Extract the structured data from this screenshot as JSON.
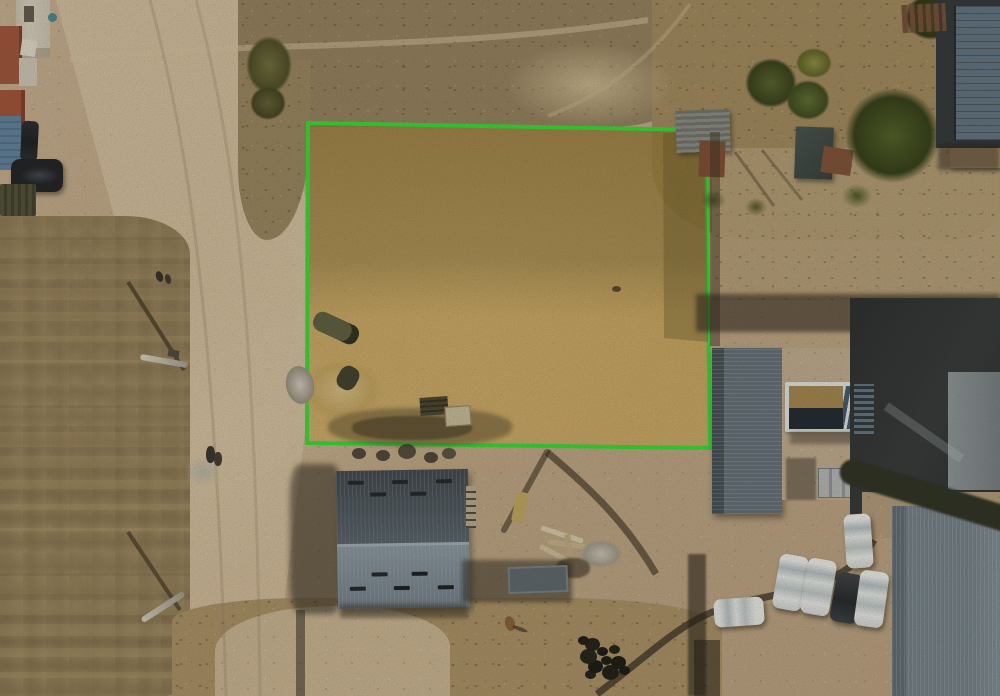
{
  "scene": {
    "kind": "aerial-drone-photo",
    "caption": "Aerial view of a vacant land plot outlined with a green boundary and filled with a yellow tint",
    "annotation": {
      "label": "Highlighted land parcel",
      "outline_color": "#2ee334",
      "fill_tint": "#d4a83c"
    },
    "labels": {
      "parcel": "Highlighted land parcel",
      "road": "Dirt road",
      "left_field": "Dry grass field",
      "top_scrub": "Scrub terrain",
      "hillside": "Dry hillside with shrubs",
      "warehouse": "Gray gable-roof warehouse",
      "house": "House with corrugated metal roof",
      "pool": "Swimming pool",
      "construction": "Building under construction",
      "bottom_right_building": "Metal-roof building",
      "parked_cars": "Parked cars",
      "white_car": "White car",
      "dark_car": "Dark car",
      "trees": "Trees and shrubs",
      "sheds": "Backyard sheds",
      "pole": "Utility pole",
      "pole_shadow": "Pole shadow",
      "top_left_buildings": "Neighboring houses",
      "pool_cover": "Pool cover",
      "rubble": "Rubble pile",
      "lumber": "Construction materials",
      "people": "People standing",
      "dog": "Animal"
    }
  }
}
